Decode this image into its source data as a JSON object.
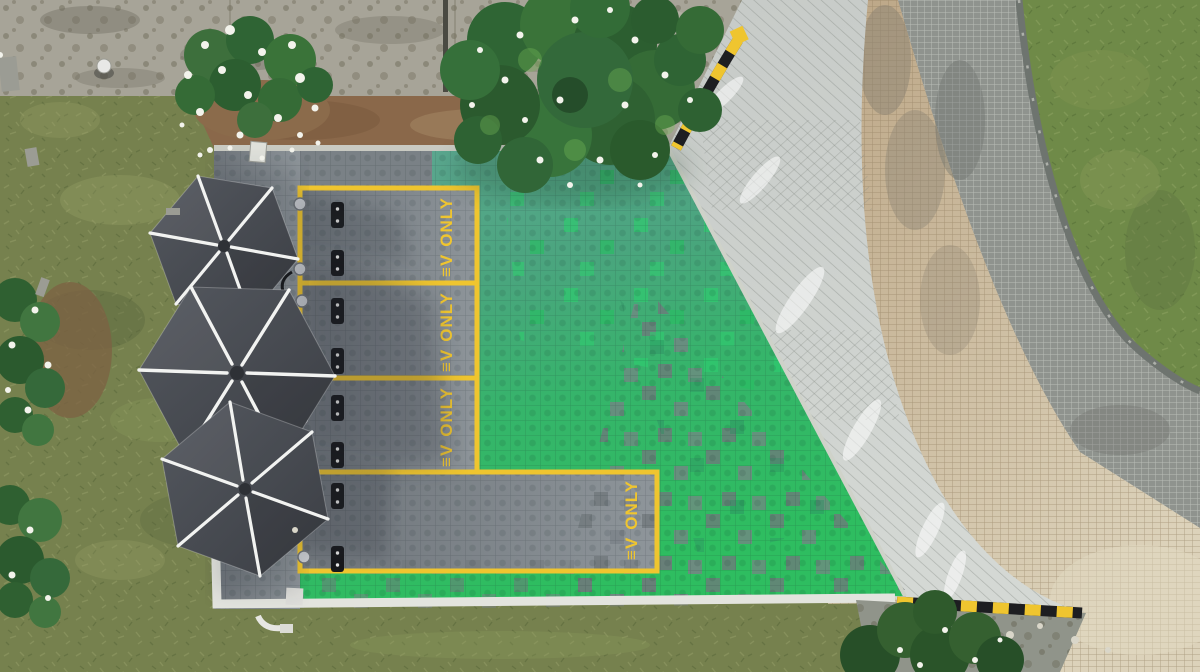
{
  "scene": {
    "bays_total": 4,
    "canopies": 3,
    "wheel_stops": 8,
    "charge_points": 6
  },
  "markings": {
    "stalls": [
      {
        "logo": "≡V",
        "word": "ONLY"
      },
      {
        "logo": "≡V",
        "word": "ONLY"
      },
      {
        "logo": "≡V",
        "word": "ONLY"
      },
      {
        "logo": "≡V",
        "word": "ONLY"
      }
    ]
  },
  "colors": {
    "marking_yellow": "#EFC52F",
    "curb_black": "#1D1E21",
    "grass_base": "#76814E",
    "grass_circle": "#6F8A48",
    "pad_teal": "#5FA693",
    "pad_green": "#2FB561",
    "tile_gray": "#7A8186",
    "walkway_concrete": "#CDD1CE",
    "brick_tan": "#C9B795",
    "paver_gray": "#8F938E",
    "canopy_gray": "#474B51",
    "canopy_rib_white": "#F2F3F1",
    "tree_green": "#2F6434",
    "flower_white": "#F3F3EC",
    "concrete_strip": "#A7A498",
    "dirt_brown": "#8A684A",
    "curb_white": "#E3E4DE",
    "wheelstop_black": "#17181B",
    "bollard_silver": "#C9CCD0"
  }
}
